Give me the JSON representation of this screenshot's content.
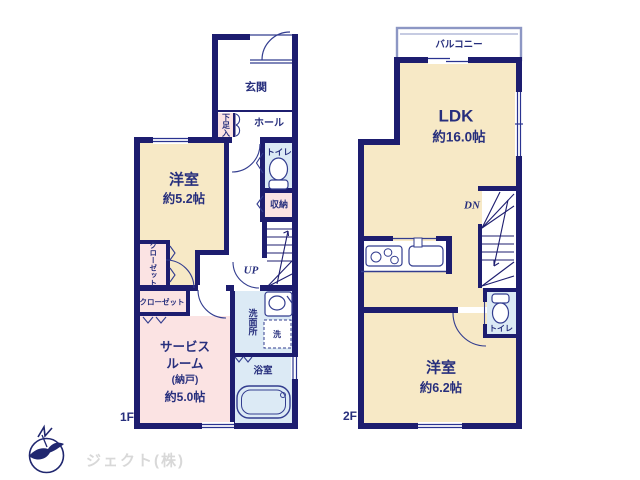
{
  "title": "2階建て住宅 間取り図",
  "colors": {
    "wall_navy": "#1d1d6f",
    "label_navy": "#272f7d",
    "room_beige": "#f7e9c6",
    "room_pink": "#fbe3e3",
    "room_blue": "#dceaf5",
    "balcony_border": "#8d97c4",
    "logo_gray": "#d8d8d8",
    "background": "#ffffff"
  },
  "floor1": {
    "label": "1F",
    "genkan": "玄関",
    "shoe": "下足入",
    "hall": "ホール",
    "toilet": "トイレ",
    "bedroom": {
      "name": "洋室",
      "size": "約5.2帖"
    },
    "storage": "収納",
    "closet_v": "クローゼット",
    "closet_h": "クローゼット",
    "service": {
      "l1": "サービス",
      "l2": "ルーム",
      "l3": "(納戸)",
      "l4": "約5.0帖"
    },
    "washroom": "洗面所",
    "washer": "洗",
    "bath": "浴室",
    "stairs": "UP"
  },
  "floor2": {
    "label": "2F",
    "balcony": "バルコニー",
    "ldk": {
      "name": "LDK",
      "size": "約16.0帖"
    },
    "stairs": "DN",
    "toilet": "トイレ",
    "bedroom": {
      "name": "洋室",
      "size": "約6.2帖"
    }
  },
  "footer": {
    "company": "ジェクト(株)"
  }
}
